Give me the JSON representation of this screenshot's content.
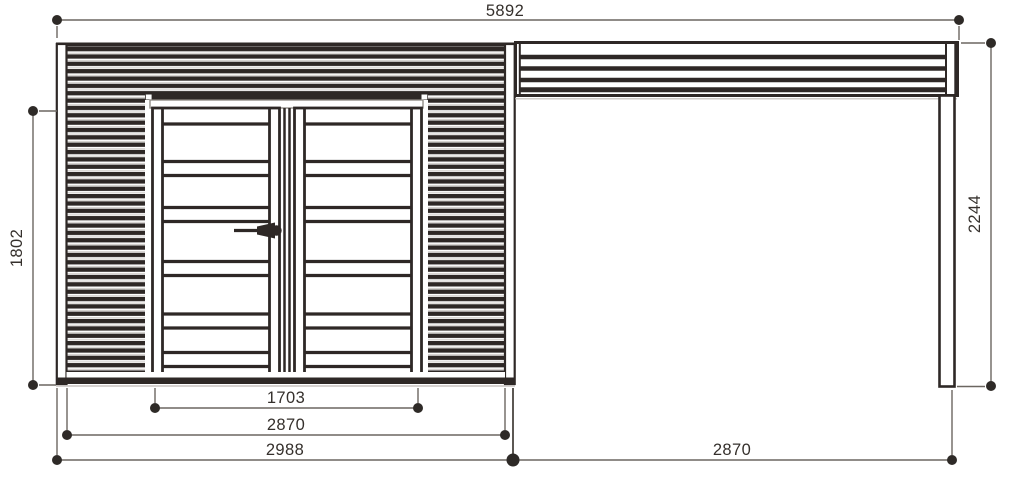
{
  "drawing": {
    "type": "technical-elevation",
    "colors": {
      "line": "#2e2826",
      "dim_line": "#6b6660",
      "shadow_line": "#bdb8b4",
      "text": "#35302c",
      "background": "#ffffff"
    },
    "dimensions": {
      "total_width": "5892",
      "left_wall_height": "1802",
      "canopy_height": "2244",
      "door_width": "1703",
      "shed_wall_width": "2870",
      "shed_overall_width": "2988",
      "canopy_width": "2870"
    }
  }
}
